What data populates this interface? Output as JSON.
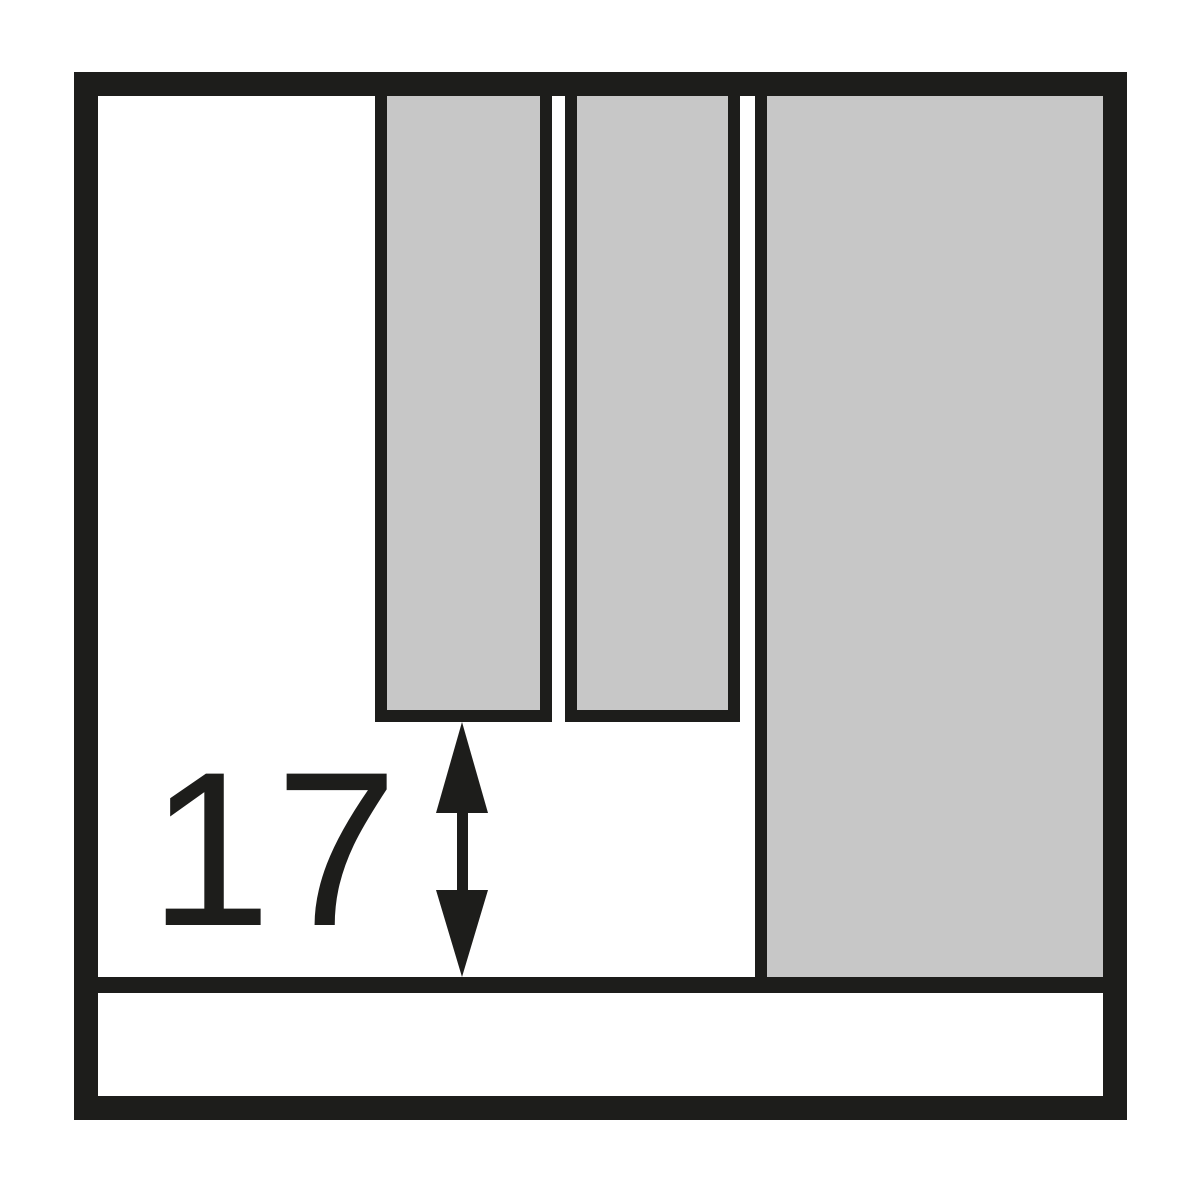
{
  "diagram": {
    "type": "technical-drawing",
    "description_hint": "front view of drawer interior with divider panels and bottom clearance dimension",
    "dimension": {
      "value": "17"
    },
    "icons": {
      "dimension_arrow": "double-headed-vertical-arrow"
    },
    "colors": {
      "line": "#1d1d1b",
      "fill": "#c7c7c7",
      "background": "#ffffff"
    }
  }
}
